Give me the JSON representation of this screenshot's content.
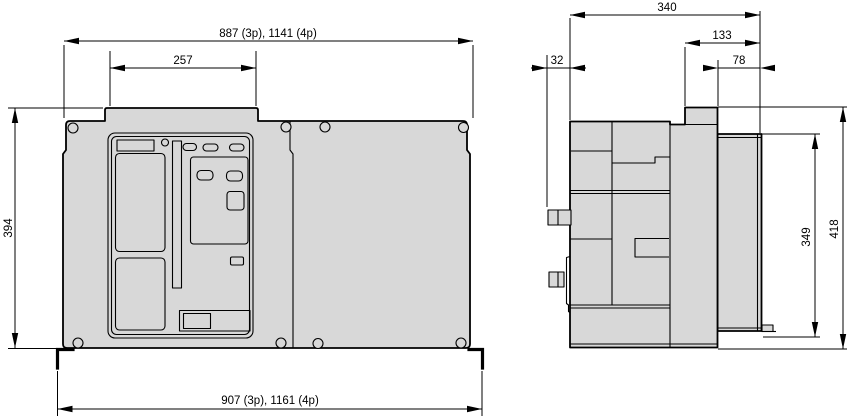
{
  "drawing": {
    "title": "Circuit-breaker dimensional drawing",
    "views": {
      "front": "front view",
      "side": "side view"
    },
    "units": "mm"
  },
  "dims": {
    "front_width_top": "887 (3p), 1141 (4p)",
    "front_top_section_width": "257",
    "front_height": "394",
    "front_width_bottom": "907 (3p), 1161 (4p)",
    "side_depth": "340",
    "side_rear_depth": "133",
    "side_front_protrusion": "32",
    "side_frame_depth": "78",
    "side_frame_height": "349",
    "side_height": "418"
  },
  "colors": {
    "body_fill": "#d8d8d8",
    "line": "#000000",
    "background": "#ffffff"
  }
}
